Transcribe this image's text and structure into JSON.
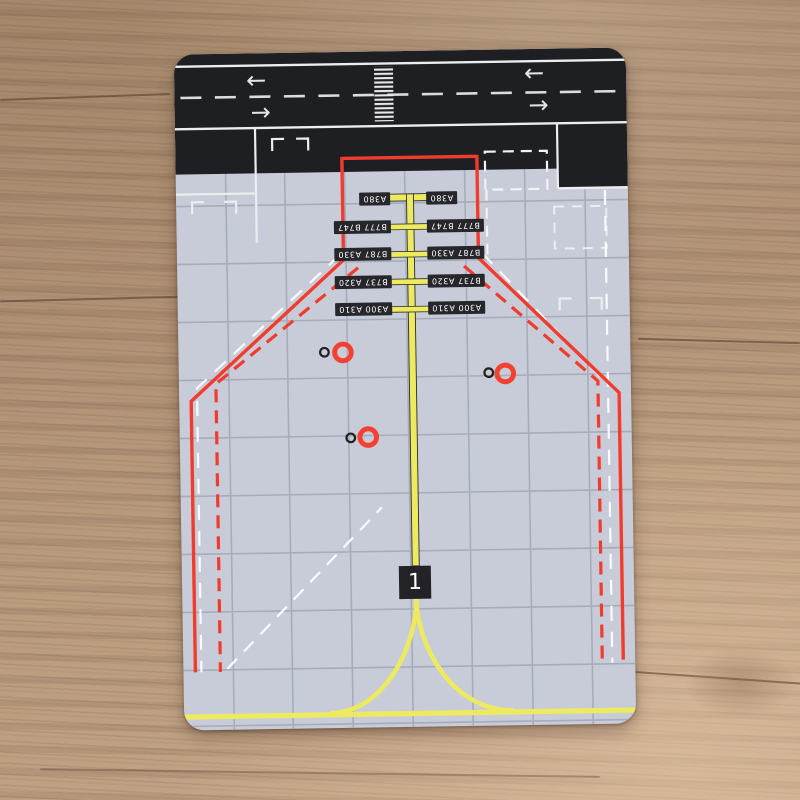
{
  "mat": {
    "bay_number": "1",
    "stand_labels": [
      "A380",
      "B777 B747",
      "B787 A330",
      "B737 A320",
      "A300 A310"
    ],
    "runway_arrows": {
      "left": "←",
      "right": "→"
    },
    "colors": {
      "mat_surface": "#c7ccd8",
      "runway_asphalt": "#1e1f23",
      "marking_white": "#ededed",
      "safety_red": "#f13b2c",
      "lead_in_yellow": "#edea60",
      "grid_line": "#a7acbb",
      "wood_table": "#b29377"
    }
  }
}
